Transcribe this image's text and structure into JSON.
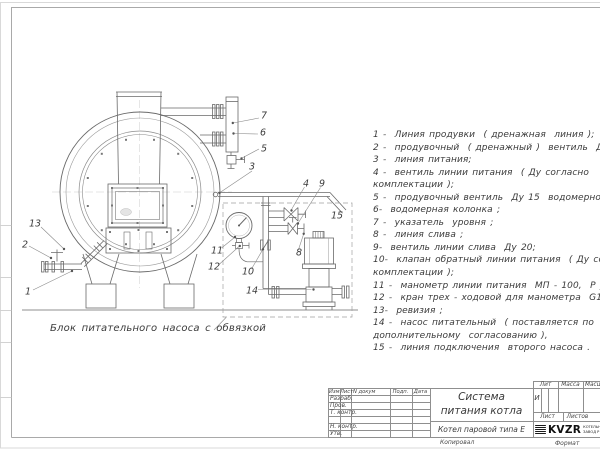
{
  "drawing": {
    "caption": "Блок питательного насоса с обвязкой",
    "callouts": [
      "1",
      "2",
      "3",
      "4",
      "5",
      "6",
      "7",
      "8",
      "9",
      "10",
      "11",
      "12",
      "13",
      "14",
      "15"
    ]
  },
  "parts_list": {
    "lines": [
      "1 -  Линия продувки  ( дренажная  линия );",
      "2 -  продувочный  ( дренажный )  вентиль  Ду 25;",
      "3 -  линия питания;",
      "4 -  вентиль линии питания  ( Ду согласно",
      "комплектации );",
      "5 -  продувочный вентиль  Ду 15  водомерной колонки",
      "6-  водомерная колонка ;",
      "7 -  указатель  уровня ;",
      "8 -  линия слива ;",
      "9-  вентиль линии слива  Ду 20;",
      "10-  клапан обратный линии питания  ( Ду согласно",
      "комплектации );",
      "11 -  манометр линии питания  МП - 100,  Р у  1,6  МПа",
      "12 -  кран трех - ходовой для манометра  G1/2- М 20",
      "13-  ревизия ;",
      "14 -  насос питательный  ( поставляется по",
      "дополнительному  согласованию ),",
      "15 -  линия подключения  второго насоса ."
    ]
  },
  "title_block": {
    "doc_title_line1": "Система",
    "doc_title_line2": "питания котла",
    "product_name": "Котел паровой типа Е",
    "header_cols": {
      "izm": "Изм",
      "list": "Лист",
      "ndoc": "N докум",
      "podp": "Подп.",
      "data": "Дата"
    },
    "rows": {
      "razrab": "Разраб.",
      "prov": "Пров.",
      "tkontr": "Т. контр.",
      "nkontr": "Н. контр.",
      "utv": "Утв."
    },
    "lit_label": "Лит",
    "massa_label": "Масса",
    "masshtab_label": "Масштаб",
    "lit_value": "И",
    "list_label": "Лист",
    "listov_label": "Листов",
    "logo_text": "KVZR",
    "logo_sub1": "КОТЕЛЬН",
    "logo_sub2": "ЗАВОД Р",
    "kopiroval_label": "Копировал",
    "format_label": "Формат"
  }
}
